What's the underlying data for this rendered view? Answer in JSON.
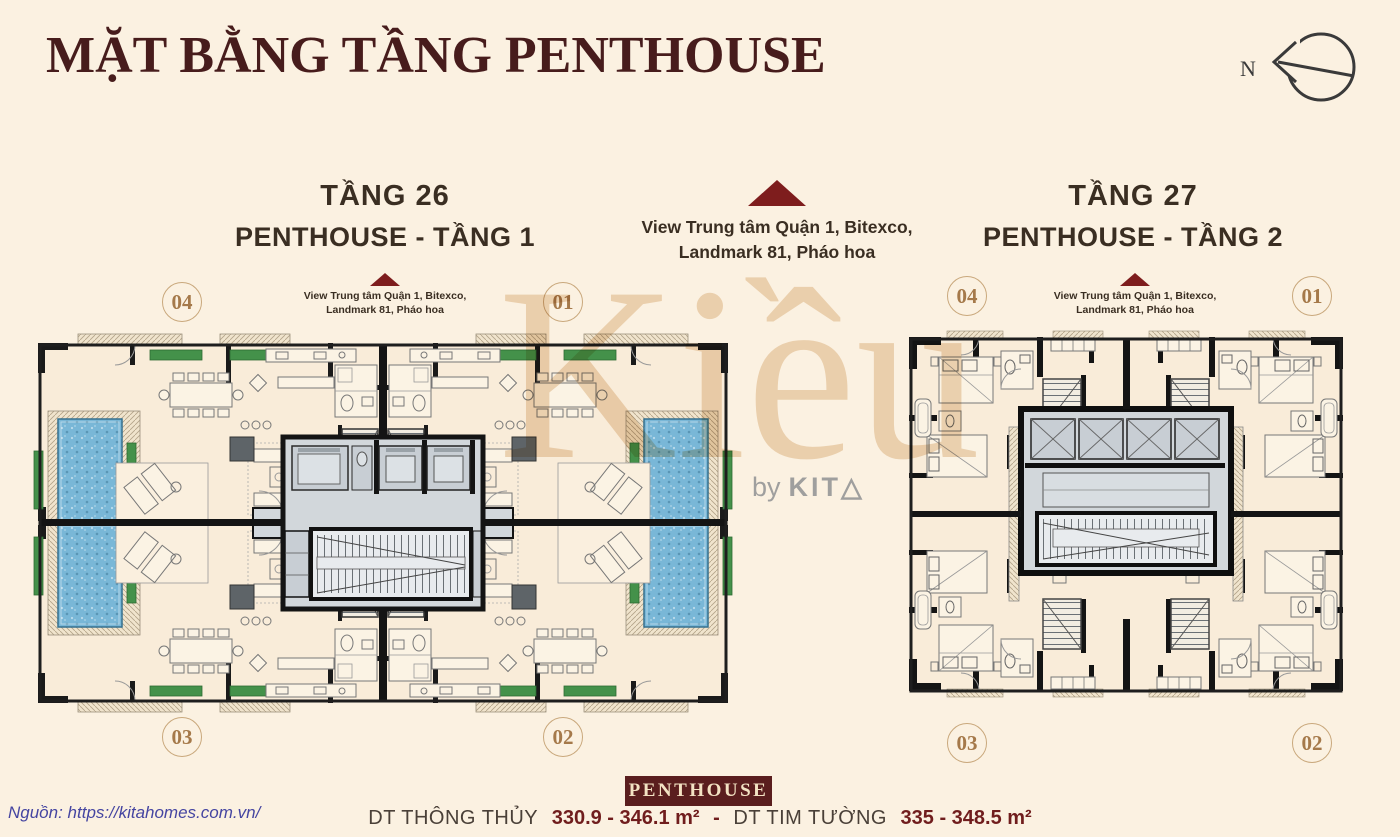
{
  "page": {
    "title": "MẶT BẰNG TẦNG PENTHOUSE"
  },
  "compass": {
    "label": "N"
  },
  "center_view": {
    "line1": "View Trung tâm Quận 1, Bitexco,",
    "line2": "Landmark 81, Pháo hoa"
  },
  "plans": {
    "left": {
      "floor": "TẦNG 26",
      "name": "PENTHOUSE - TẦNG 1",
      "view_note": {
        "line1": "View Trung tâm Quận 1, Bitexco,",
        "line2": "Landmark 81, Pháo hoa"
      },
      "units": {
        "top_left": "04",
        "top_right": "01",
        "bottom_left": "03",
        "bottom_right": "02"
      }
    },
    "right": {
      "floor": "TẦNG 27",
      "name": "PENTHOUSE - TẦNG 2",
      "view_note": {
        "line1": "View Trung tâm Quận 1, Bitexco,",
        "line2": "Landmark 81, Pháo hoa"
      },
      "units": {
        "top_left": "04",
        "top_right": "01",
        "bottom_left": "03",
        "bottom_right": "02"
      }
    }
  },
  "watermark": {
    "text": "Kiều",
    "by": "by",
    "brand": "KIT",
    "brand_mark": "△"
  },
  "footer": {
    "badge": "PENTHOUSE",
    "area1_label": "DT THÔNG THỦY",
    "area1_value": "330.9 - 346.1 m²",
    "separator": "-",
    "area2_label": "DT TIM TƯỜNG",
    "area2_value": "335 - 348.5 m²"
  },
  "source": {
    "text": "Nguồn: https://kitahomes.com.vn/"
  },
  "colors": {
    "background": "#FBF1E1",
    "title_maroon": "#471C1C",
    "triangle_accent": "#7E1D1D",
    "heading_brown": "#3A2E22",
    "unit_gold": "#A5794A",
    "pool_blue": "#79B7D7",
    "planter_green": "#44914A",
    "wall_black": "#141414",
    "core_gray": "#D2D7DB",
    "badge_bg": "#5A1E1E",
    "badge_text": "#F3E3C3",
    "value_maroon": "#701D1D",
    "source_blue": "#4545A1",
    "watermark_tan": "#D7A96F"
  }
}
